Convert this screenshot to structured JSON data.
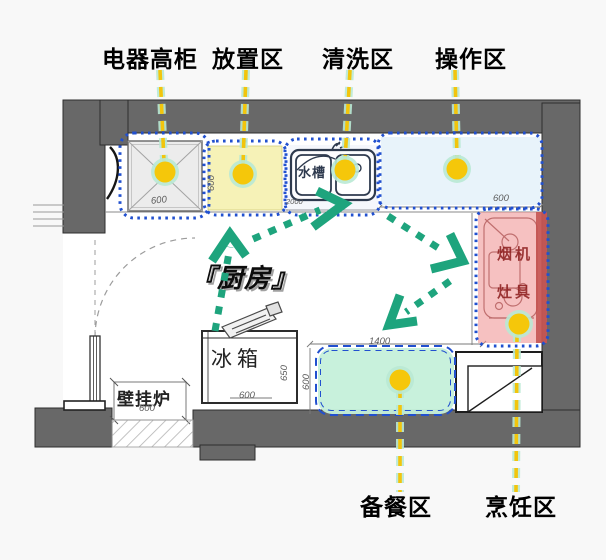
{
  "zone_labels": {
    "appliance_cabinet": "电器高柜",
    "placement": "放置区",
    "washing": "清洗区",
    "operation": "操作区",
    "prep": "备餐区",
    "cooking": "烹饪区"
  },
  "room": {
    "name": "『厨房』",
    "fridge_label": "冰箱",
    "boiler_label": "壁挂炉",
    "sink_label": "水槽",
    "hood_label": "烟机",
    "stove_label": "灶具"
  },
  "dimensions": {
    "cabinet_width": "600",
    "placement_depth": "600",
    "sink_counter": "2000",
    "operation_width": "600",
    "prep_width": "1400",
    "prep_depth": "600",
    "fridge_width": "600",
    "fridge_depth": "650",
    "boiler_width": "600"
  },
  "colors": {
    "zone_border_blue": "#2150cf",
    "placement_fill": "#f5f1ae",
    "operation_fill": "#e7f2fa",
    "cooking_fill": "#ef8e8e",
    "prep_fill": "#c5f0da",
    "marker_yellow": "#f5c70a",
    "marker_glow": "#b9e9d4",
    "arrow_green": "#1ea47d",
    "wall_gray": "#686868"
  }
}
